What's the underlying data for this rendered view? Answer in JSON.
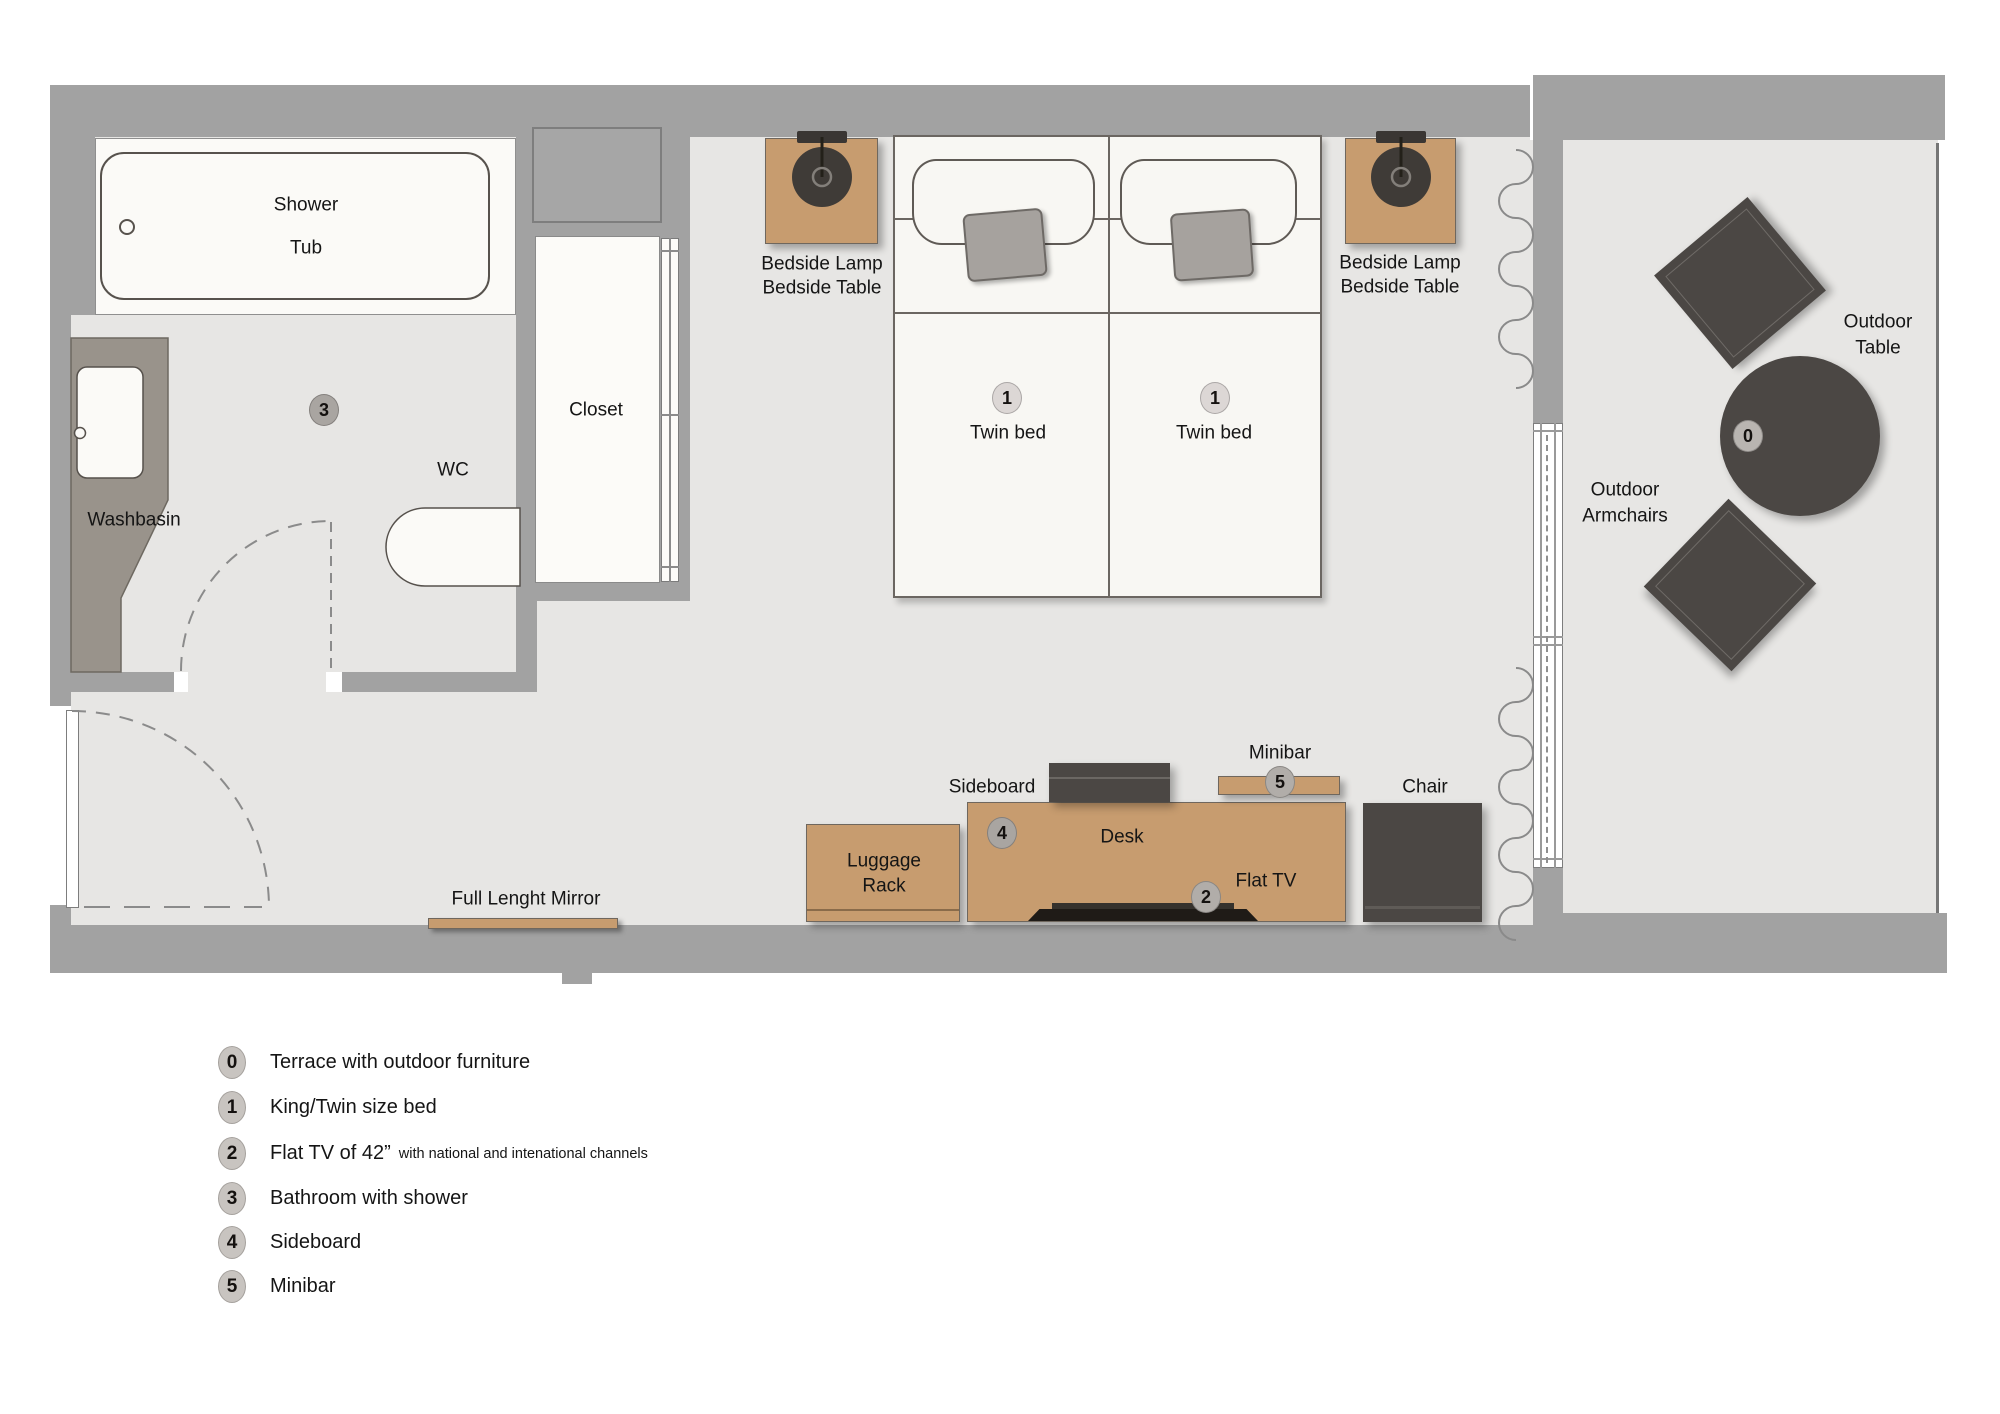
{
  "plan": {
    "labels": {
      "shower": "Shower",
      "tub": "Tub",
      "washbasin": "Washbasin",
      "wc": "WC",
      "closet": "Closet",
      "bedside_lamp": "Bedside Lamp",
      "bedside_table": "Bedside Table",
      "twin_bed": "Twin bed",
      "outdoor": "Outdoor",
      "table": "Table",
      "armchairs": "Armchairs",
      "sideboard": "Sideboard",
      "minibar": "Minibar",
      "desk": "Desk",
      "flat_tv": "Flat TV",
      "chair": "Chair",
      "luggage": "Luggage",
      "rack": "Rack",
      "mirror": "Full Lenght Mirror"
    },
    "badges": {
      "b0": "0",
      "b1": "1",
      "b2": "2",
      "b3": "3",
      "b4": "4",
      "b5": "5"
    }
  },
  "legend": {
    "items": [
      {
        "num": "0",
        "text": "Terrace with outdoor furniture"
      },
      {
        "num": "1",
        "text": "King/Twin size bed"
      },
      {
        "num": "2",
        "text": "Flat TV of 42”",
        "note": "with national and intenational channels"
      },
      {
        "num": "3",
        "text": "Bathroom with shower"
      },
      {
        "num": "4",
        "text": "Sideboard"
      },
      {
        "num": "5",
        "text": "Minibar"
      }
    ]
  },
  "colors": {
    "wall": "#a2a2a2",
    "floor": "#e7e6e4",
    "fixture_white": "#fbfaf7",
    "wood": "#c79c6f",
    "dark_furniture": "#4b4744",
    "counter": "#99938b",
    "badge_gray": "#b5b1ad"
  }
}
